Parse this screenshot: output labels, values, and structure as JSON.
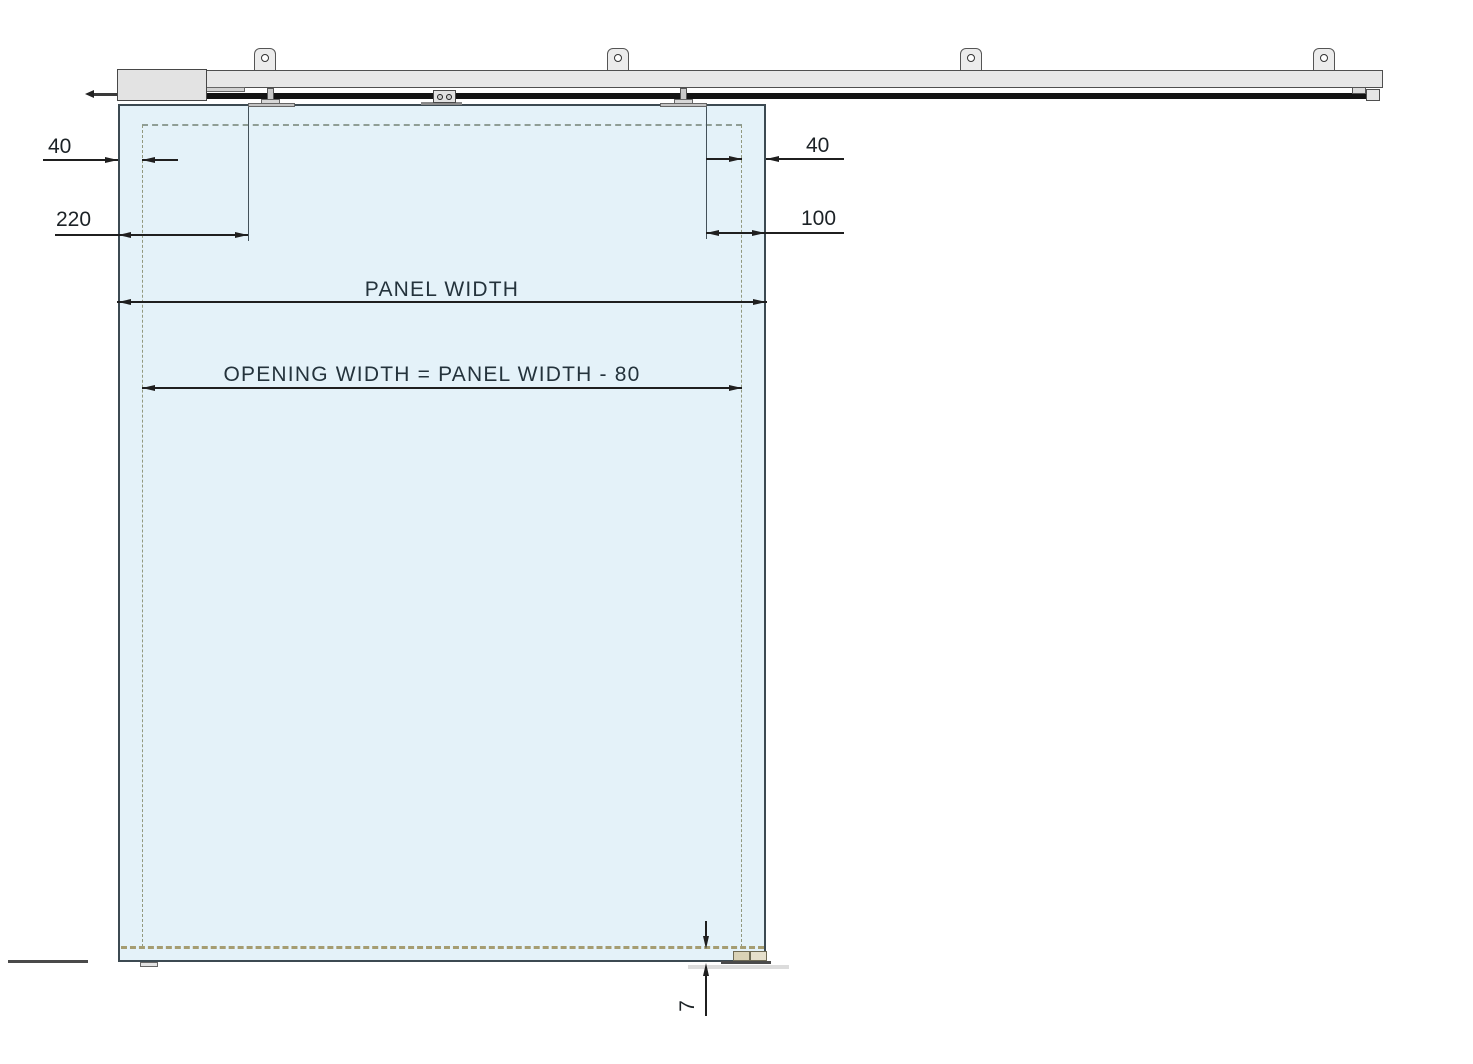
{
  "drawing": {
    "title": "Sliding glass door system - front elevation",
    "labels": {
      "left_glass_offset": "40",
      "left_carriage_distance": "220",
      "right_glass_offset": "40",
      "right_carriage_distance": "100",
      "panel_width": "PANEL WIDTH",
      "opening_width": "OPENING WIDTH = PANEL WIDTH - 80",
      "floor_gap": "7"
    },
    "colors": {
      "panel_fill": "#e4f2f9",
      "panel_outline": "#3c4a52",
      "track_fill": "#e7e7e7",
      "rail": "#131313",
      "opening_dashed": "#8f9e96",
      "bottom_seal_dashed": "#a59d72",
      "floor_guide_fill": "#d9d2b6",
      "dimension_lines": "#1f1f1f",
      "dimension_text": "#24333c"
    },
    "components": {
      "ceiling_brackets_count": 4,
      "trolleys_count": 2
    }
  }
}
